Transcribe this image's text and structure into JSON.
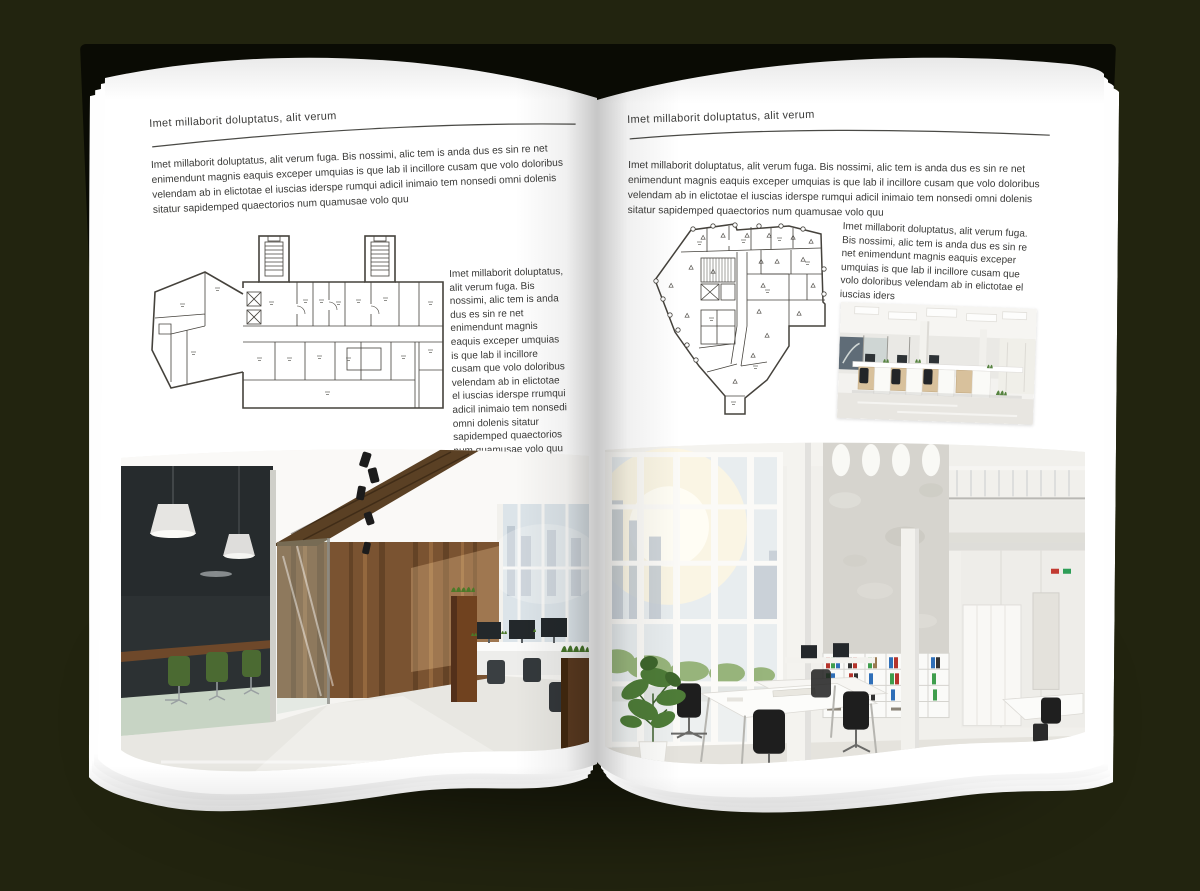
{
  "canvas": {
    "background": "#22240f"
  },
  "book": {
    "cover_color": "#0a0b04",
    "page_color": "#ffffff"
  },
  "left_page": {
    "kicker": "Imet millaborit doluptatus, alit verum",
    "intro": "Imet millaborit doluptatus, alit verum fuga. Bis nossimi, alic tem is anda dus es sin re net enimendunt magnis eaquis exceper umquias is que lab il incillore cusam que volo doloribus velendam ab in elictotae el iuscias iderspe rumqui adicil inimaio tem nonsedi omni dolenis sitatur sapidemped quaectorios num quamusae volo quu",
    "side_text": "Imet millaborit doluptatus, alit verum fuga. Bis nossimi, alic tem is anda dus es sin re net enimendunt magnis eaquis exceper umquias is que lab il incillore cusam que volo doloribus velendam ab in elictotae el iuscias iderspe rrumqui adicil inimaio tem nonsedi omni dolenis sitatur sapidemped quaectorios num quamusae volo quu",
    "floorplan_label": "wide-building-floor-plan",
    "photo_label": "wood-and-glass-office-interior"
  },
  "right_page": {
    "kicker": "Imet millaborit doluptatus, alit verum",
    "intro": "Imet millaborit doluptatus, alit verum fuga. Bis nossimi, alic tem is anda dus es sin re net enimendunt magnis eaquis exceper umquias is que lab il incillore cusam que volo doloribus velendam ab in elictotae el iuscias iderspe rumqui adicil inimaio tem nonsedi omni dolenis sitatur sapidemped quaectorios num quamusae volo quu",
    "side_text": "Imet millaborit doluptatus, alit verum fuga. Bis nossimi, alic tem is anda dus es sin re net enimendunt magnis eaquis exceper umquias is que lab il incillore cusam que volo doloribus velendam ab in elictotae el iuscias iders",
    "floorplan_label": "irregular-building-floor-plan",
    "photo_small_label": "open-plan-office-desks",
    "photo_label": "atrium-office-interior"
  },
  "palette": {
    "background": "#22240f",
    "cover": "#0a0b04",
    "page": "#ffffff",
    "text": "#3b3b39",
    "rule": "#4a4a46",
    "plan_stroke": "#45423c",
    "wood": "#7a5331",
    "wood_dark": "#5a4024",
    "chair_green": "#4b6a32",
    "plant_green": "#4e7c38",
    "binder_red": "#b5342c",
    "binder_green": "#3f9e4d",
    "binder_blue": "#2f6fb8"
  }
}
